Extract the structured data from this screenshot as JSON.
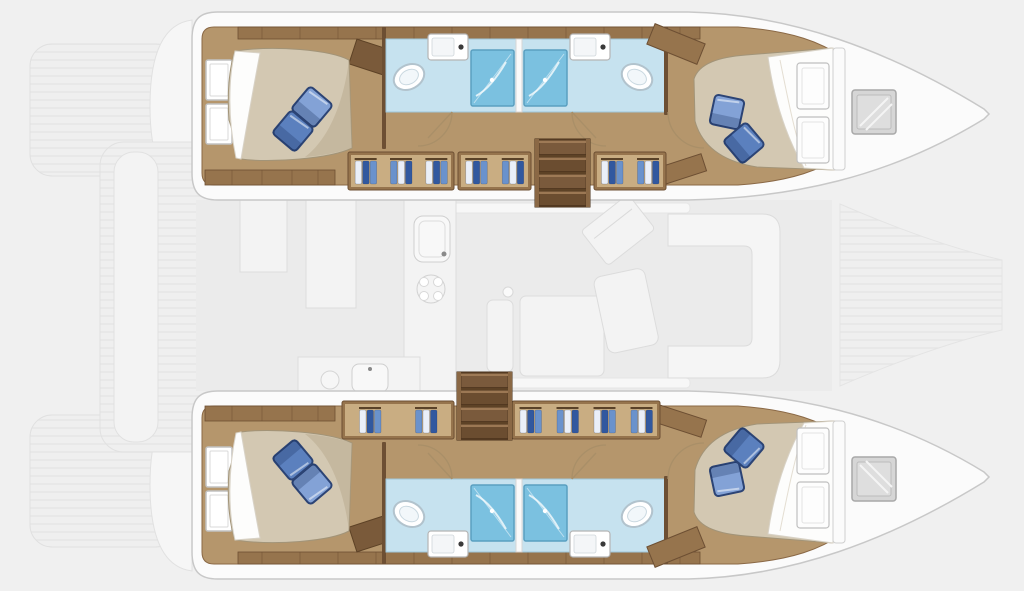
{
  "meta": {
    "description": "Top-down interior layout floor plan of a sailing catamaran with two hulls, four cabins, four bathrooms and a central saloon (surroundings faded)",
    "visible_text": "none"
  },
  "colors": {
    "bg": "#f0f0f0",
    "deck_white": "#fbfbfb",
    "deck_stroke": "#c8c8c8",
    "wood_floor": "#b5966c",
    "wood_band": "#96744d",
    "wood_trim": "#6d4f33",
    "wood_line": "#8a6845",
    "duvet": "#d3c8b2",
    "duvet_shadow": "#b9ac90",
    "sheet": "#fdfdfc",
    "pillow_dark": "#5b80be",
    "pillow_light": "#83a2d6",
    "pillow_border": "#2c4475",
    "bath_floor": "#c6e2ef",
    "bath_edge": "#9fc6da",
    "shower": "#7bc1e0",
    "shower_frame": "#5a9fc0",
    "fixture_stroke": "#b2c3cd",
    "hatch_fill": "#d6d6d6",
    "hatch_stroke": "#a8a8a8",
    "stair_dark": "#5d4226",
    "stair_tread": "#7a5a3c",
    "stair_tread_alt": "#6b4d30",
    "stair_rail": "#8a6845",
    "stair_edge": "#a5805a",
    "locker_inner": "#c9ad82",
    "clothes_white": "#eaeff8",
    "clothes_blue": "#6a92cc",
    "clothes_navy": "#31589f",
    "faded_fill": "#f3f3f3",
    "faded_stroke": "#dcdcdc",
    "saloon_fill": "#ebebeb"
  },
  "inventory": {
    "hulls": 2,
    "cabins": 4,
    "bathrooms": 4,
    "showers": 4,
    "toilets": 4,
    "bathroom_sinks": 4,
    "double_beds": 4,
    "pillows_per_bed": 2,
    "bow_deck_hatches": 2,
    "companionway_stairs": 2
  },
  "stairs": [
    {
      "id": "stairs-top",
      "x": 535,
      "y": 139,
      "w": 55,
      "h": 68,
      "treads": 4
    },
    {
      "id": "stairs-bottom",
      "x": 457,
      "y": 372,
      "w": 55,
      "h": 68,
      "treads": 4
    }
  ],
  "locker_rows": [
    {
      "id": "lockers-top",
      "y": 152,
      "h": 38,
      "segments": [
        {
          "x": 348,
          "w": 106,
          "items": 3
        },
        {
          "x": 458,
          "w": 73,
          "items": 2
        },
        {
          "x": 594,
          "w": 72,
          "items": 2
        }
      ]
    },
    {
      "id": "lockers-bottom",
      "y": 401,
      "h": 38,
      "segments": [
        {
          "x": 342,
          "w": 112,
          "items": 2
        },
        {
          "x": 512,
          "w": 148,
          "items": 4
        }
      ]
    }
  ],
  "saloon_features": [
    "galley-counter",
    "galley-sink",
    "stove",
    "aft-galley-counter",
    "saloon-table",
    "bench-seat",
    "nav-station",
    "l-sofa",
    "mast-post"
  ],
  "exterior_features": [
    "aft-cockpit",
    "cockpit-bench",
    "transom-steps-port",
    "transom-steps-starboard",
    "foredeck"
  ]
}
